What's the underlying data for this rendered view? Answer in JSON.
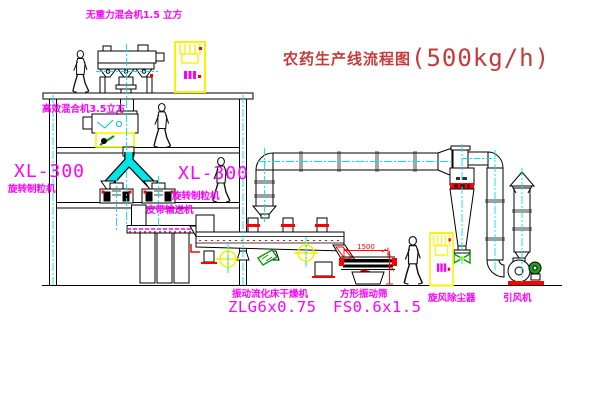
{
  "title": {
    "name": "农药生产线流程图",
    "capacity": "(500kg/h)"
  },
  "labels": {
    "top_mixer": "无重力混合机1.5 立方",
    "floor2_mixer": "高效混合机3.5立方",
    "xl_left_model": "XL-300",
    "xl_left_name": "旋转制粒机",
    "xl_mid_model": "XL-300",
    "xl_mid_name": "旋转制粒机",
    "belt_conveyor": "皮带输送机",
    "dryer_name": "振动流化床干燥机",
    "dryer_model": "ZLG6x0.75",
    "sieve_name": "方形振动筛",
    "sieve_model": "FS0.6x1.5",
    "cyclone": "旋风除尘器",
    "fan": "引风机"
  },
  "dimensions": {
    "sieve_length_mm": "1500",
    "sieve_height_mm": "340"
  },
  "colors": {
    "label_magenta": "#ff00ff",
    "title_red": "#c83a3a",
    "centerline_cyan": "#00e5e5",
    "cabinet_yellow": "#f5f500",
    "accent_red": "#ff0000",
    "valve_green": "#00a000",
    "line_black": "#000000"
  }
}
